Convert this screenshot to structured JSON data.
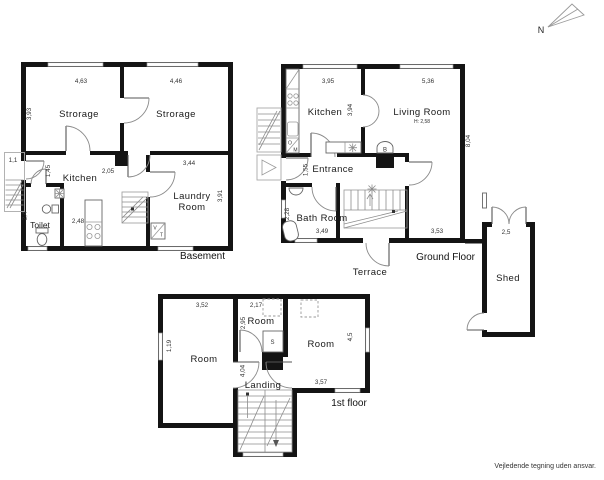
{
  "compass": {
    "north": "N"
  },
  "footer": {
    "note": "Vejledende tegning uden ansvar."
  },
  "basement": {
    "title": "Basement",
    "rooms": {
      "storage_left": "Strorage",
      "storage_right": "Strorage",
      "kitchen": "Kitchen",
      "toilet": "Toilet",
      "laundry_line1": "Laundry",
      "laundry_line2": "Room",
      "washer": "V",
      "dryer": "T"
    },
    "dims": {
      "storage_left_w": "4,63",
      "storage_right_w": "4,46",
      "storage_left_h": "3,93",
      "entry_stair_w": "1,1",
      "kitchen_h": "1,45",
      "hall_w": "2,05",
      "laundry_w": "3,44",
      "laundry_h": "3,91",
      "toilet_h": "2,4",
      "kitchen_w": "2,48"
    }
  },
  "ground": {
    "title": "Ground Floor",
    "rooms": {
      "kitchen": "Kitchen",
      "living": "Living Room",
      "living_note": "H: 2,58",
      "entrance": "Entrance",
      "bath": "Bath Room",
      "terrace": "Terrace",
      "boiler": "B",
      "oven": "O",
      "micro": "M"
    },
    "dims": {
      "kitchen_w": "3,95",
      "kitchen_h": "3,94",
      "living_w": "5,36",
      "living_h": "8,04",
      "entrance_h": "1,55",
      "bath_h": "2,28",
      "bath_w": "3,49",
      "living_bottom_w": "3,53"
    }
  },
  "shed": {
    "label": "Shed",
    "width": "2,5"
  },
  "first": {
    "title": "1st floor",
    "rooms": {
      "room_left": "Room",
      "room_middle": "Room",
      "room_right": "Room",
      "landing": "Landing",
      "closet": "S"
    },
    "dims": {
      "room_left_w": "3,52",
      "room_left_h": "1,19",
      "room_middle_w": "2,17",
      "room_middle_h": "2,95",
      "room_right_h": "4,5",
      "room_right_w": "3,57",
      "landing_h": "4,04"
    }
  }
}
